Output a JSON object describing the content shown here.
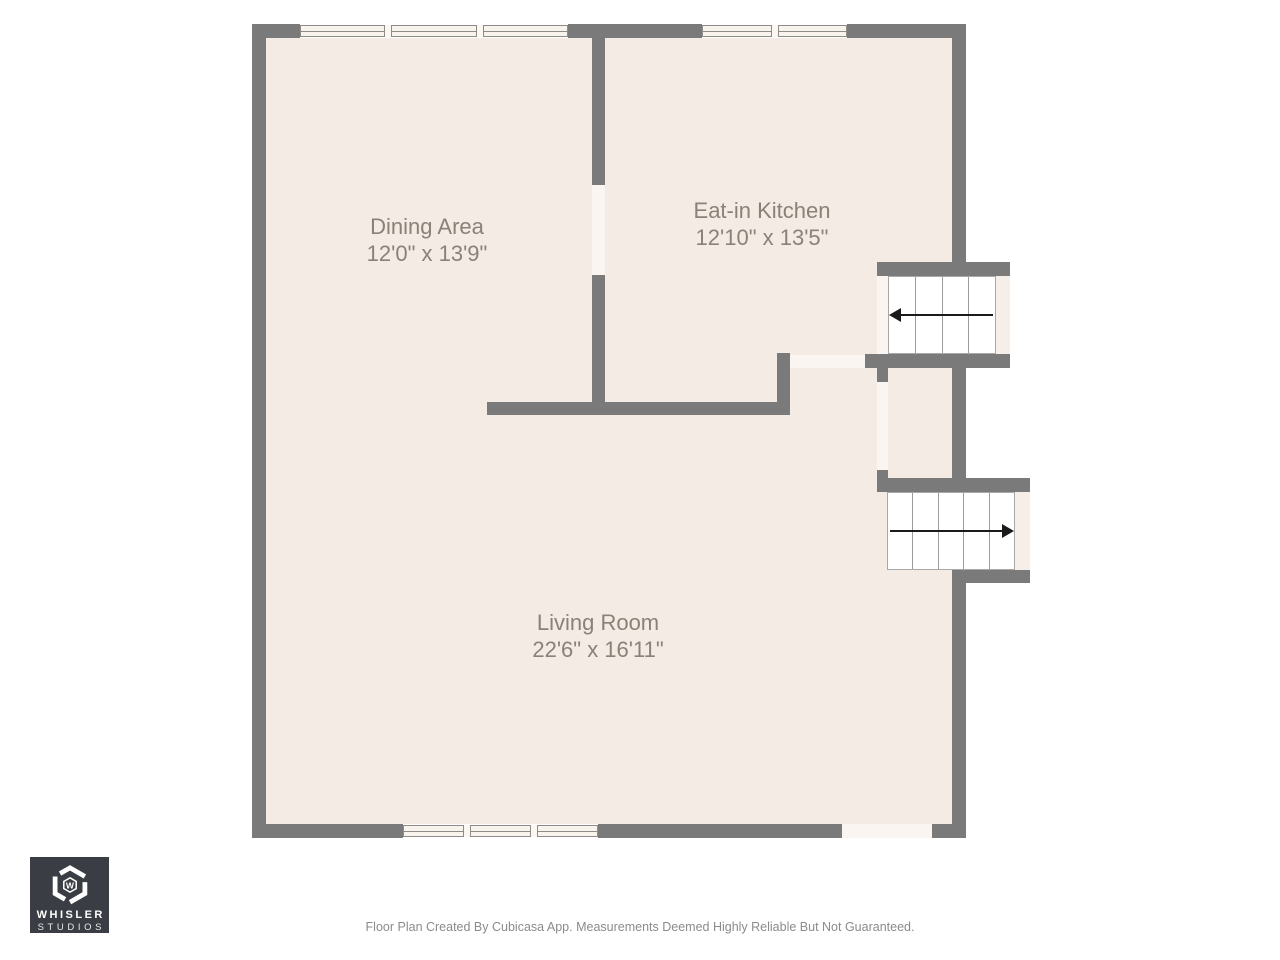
{
  "rooms": [
    {
      "name": "Dining Area",
      "dims": "12'0\" x 13'9\""
    },
    {
      "name": "Eat-in Kitchen",
      "dims": "12'10\" x 13'5\""
    },
    {
      "name": "Living Room",
      "dims": "22'6\" x 16'11\""
    }
  ],
  "stairs": [
    {
      "location": "upper-right",
      "steps": 4,
      "direction": "left"
    },
    {
      "location": "lower-right",
      "steps": 5,
      "direction": "right"
    }
  ],
  "windows": [
    {
      "location": "top-left",
      "panes": 3
    },
    {
      "location": "top-right",
      "panes": 2
    },
    {
      "location": "bottom",
      "panes": 3
    }
  ],
  "logo": {
    "line1": "WHISLER",
    "line2": "STUDIOS",
    "monogram": "W"
  },
  "footer": {
    "disclaimer": "Floor Plan Created By Cubicasa App. Measurements Deemed Highly Reliable But Not Guaranteed."
  },
  "colors": {
    "wall": "#7a7a7a",
    "room_fill": "#f4ebe5",
    "opening_fill": "#faf5f0",
    "stair_fill": "#ffffff",
    "stair_line": "#9b9b9b",
    "arrow": "#1a1a1a",
    "label_text": "#8a8177",
    "footer_text": "#8b8b8b",
    "logo_background": "#3a3d43"
  }
}
